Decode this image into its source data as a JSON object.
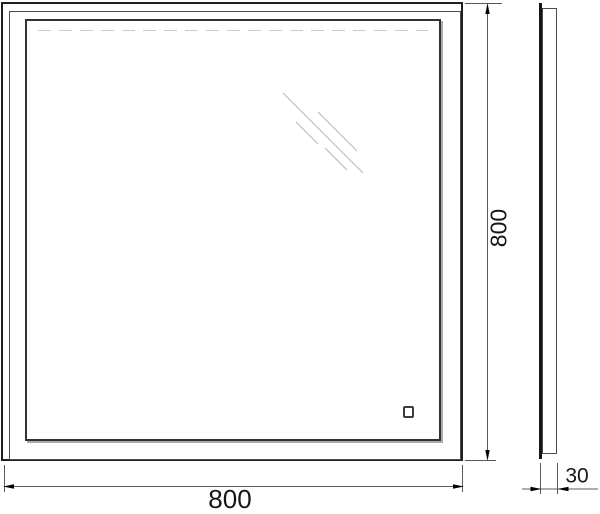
{
  "drawing": {
    "type": "technical-dimension-drawing",
    "subject": "square-led-mirror",
    "views": {
      "front": {
        "name": "front view",
        "shape": "square double frame"
      },
      "side": {
        "name": "side profile view",
        "shape": "thin vertical slab"
      }
    },
    "dimensions": {
      "height": "800",
      "width": "800",
      "depth": "30"
    },
    "icons": [
      "glare-reflection-icon",
      "touch-sensor-button",
      "led-strip-dashed-line"
    ],
    "colors": {
      "frame_line": "#1f1f1f",
      "inner_frame_line": "#333333",
      "frame_shadow": "#ababab",
      "dimension_line": "#5a5a5a",
      "arrowhead": "#000000",
      "glare_line": "#c6c6c6",
      "led_dash_line": "#cccccc",
      "text": "#161616",
      "background": "#ffffff"
    }
  }
}
